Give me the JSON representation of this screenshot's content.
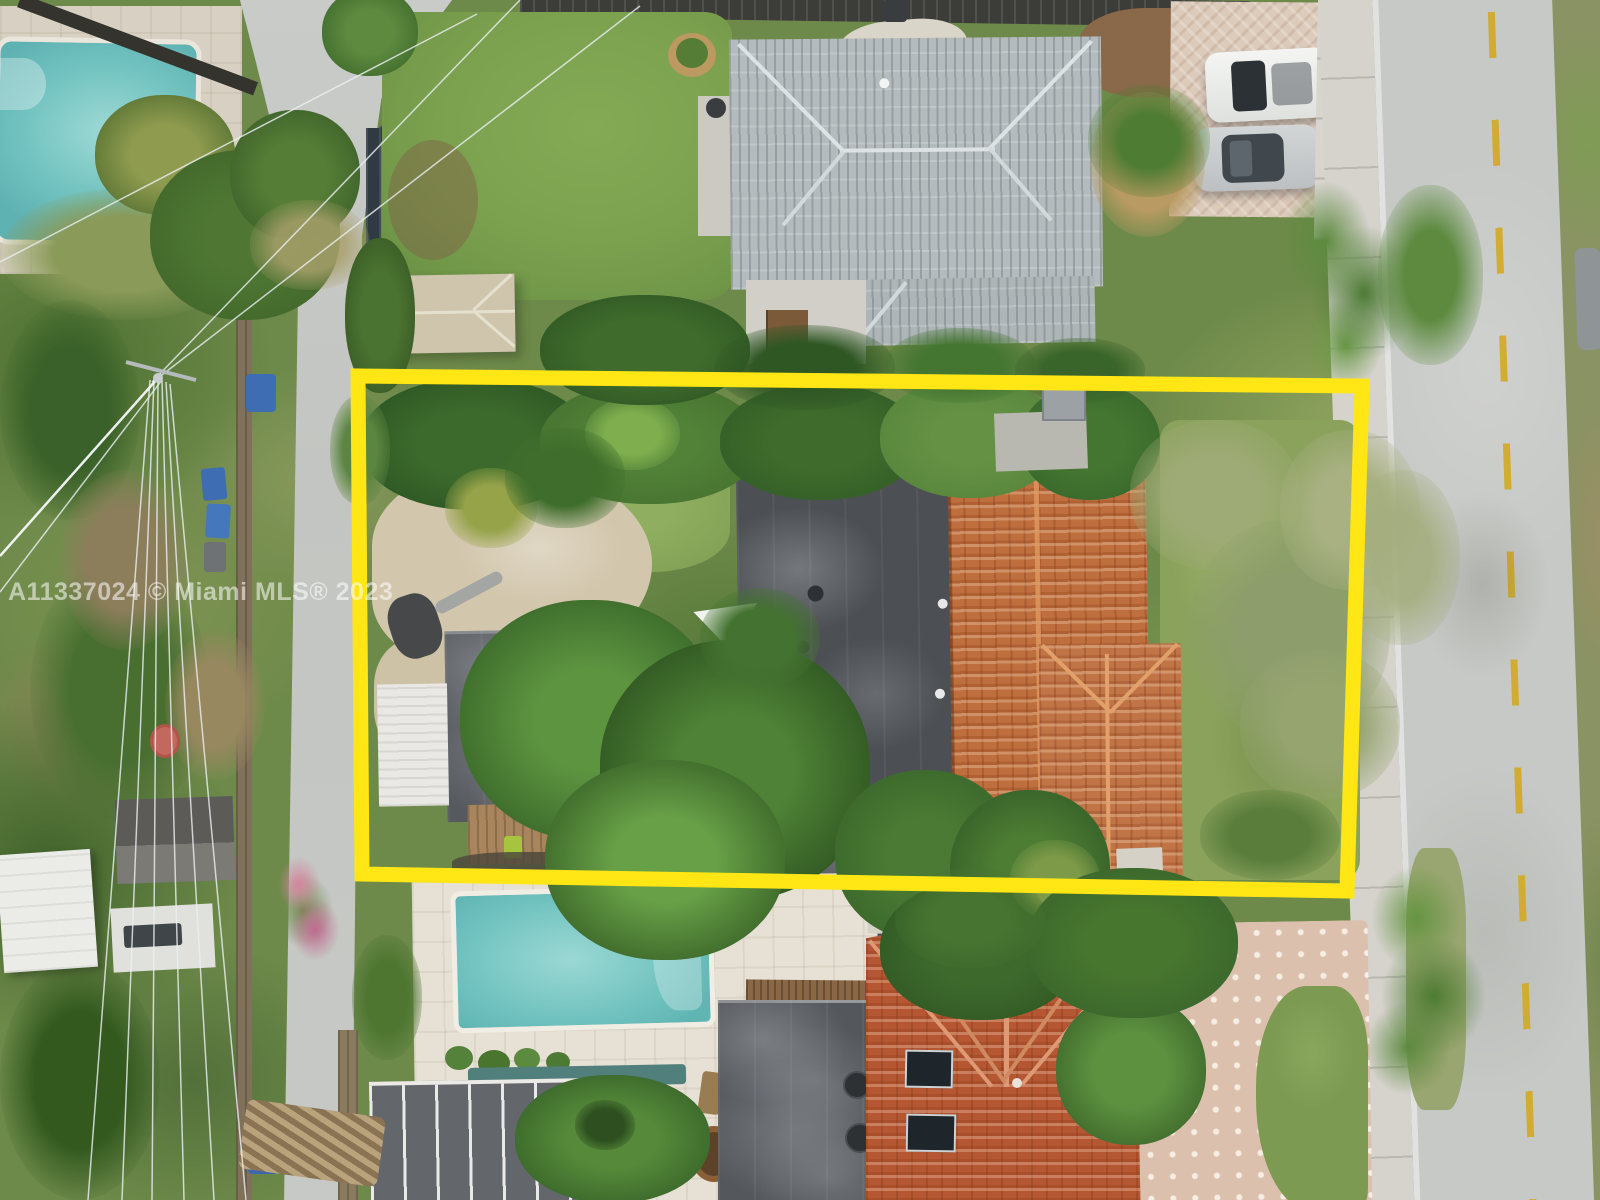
{
  "meta": {
    "type": "aerial-drone-photo",
    "width": 1600,
    "height": 1200,
    "description": "Overhead aerial view of a residential lot outlined with a yellow property-boundary box; Miami MLS listing photo"
  },
  "watermark": {
    "text": "A11337024 © Miami MLS® 2023",
    "color": "#ffffff",
    "opacity": 0.55
  },
  "boundary": {
    "shape": "quadrilateral",
    "color": "#ffe614",
    "stroke_width": 15,
    "corners": [
      [
        358,
        376
      ],
      [
        1362,
        386
      ],
      [
        1347,
        891
      ],
      [
        362,
        874
      ]
    ]
  },
  "palette": {
    "boundary_yellow": "#ffe614",
    "pool_water": "#72c3c0",
    "pool_water_top": "#66bfc0",
    "gray_tile_roof": "#b4bbbd",
    "dark_flat_roof": "#4c5054",
    "terracotta_roof": "#bf6f3e",
    "red_tile_roof": "#b65733",
    "street_asphalt": "#c7c9c6",
    "street_dash_yellow": "#d2ab2a",
    "concrete_drive": "#d2c6ac",
    "paver_driveway": "#dcc0ae",
    "lawn_green": "#7ba14f"
  },
  "scene": {
    "features": [
      "neighbor-pool-top-left",
      "rear-alley-road",
      "privacy-fences",
      "power-lines",
      "utility-pole",
      "neighbor-house-gray-tile-roof",
      "backyard-pavilion",
      "stone-paths",
      "neighbor-driveway",
      "white-suv",
      "silver-sedan",
      "street-right",
      "sidewalk",
      "street-center-dashes",
      "property-boundary-overlay",
      "main-house-flat-roof",
      "main-house-tile-roof",
      "main-house-wing-roof",
      "garage-flat-roof",
      "carport-awning",
      "wood-deck",
      "concrete-apron",
      "large-shade-tree",
      "shade-sail",
      "dry-tree-east-yard",
      "swimming-pool-south",
      "pool-deck-south",
      "pergola",
      "neighbor-house-flat-roof-south",
      "neighbor-house-red-tile-roof-south",
      "skylights",
      "paver-driveway-south",
      "palm-trees",
      "white-trailer",
      "storage-sheds",
      "trash-bins",
      "bougainvillea"
    ]
  }
}
